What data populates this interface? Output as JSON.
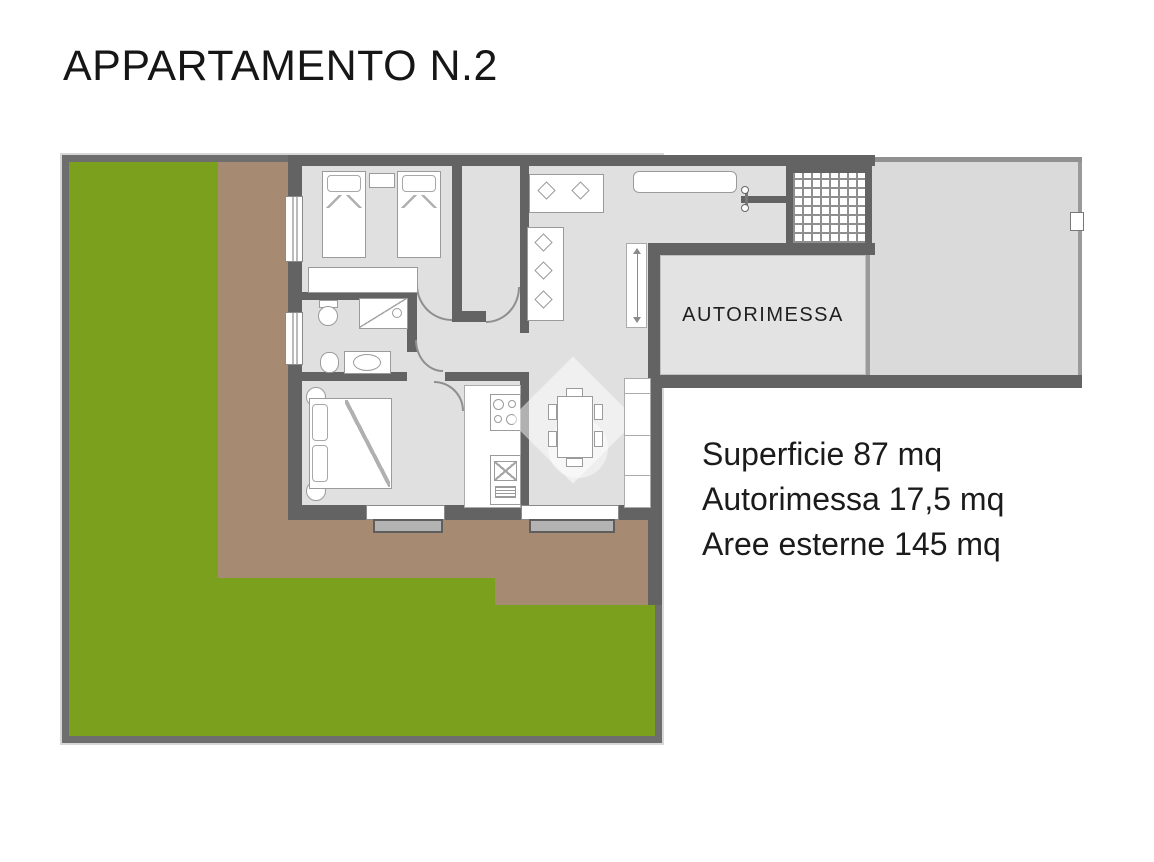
{
  "title": "APPARTAMENTO N.2",
  "plan": {
    "garage_label": "AUTORIMESSA"
  },
  "stats": {
    "lines": [
      {
        "text": "Superficie 87 mq"
      },
      {
        "text": "Autorimessa 17,5 mq"
      },
      {
        "text": "Aree esterne 145 mq"
      }
    ]
  },
  "colors": {
    "lawn": "#7aa01d",
    "terrace": "#a78a72",
    "wall": "#636363",
    "enclosure_wall": "#6e6e6e",
    "apartment_floor": "#e0e0e0",
    "garage_floor": "#e3e3e3",
    "driveway": "#dadada",
    "furniture_outline": "#9b9b9b",
    "text": "#1b1b1b"
  }
}
